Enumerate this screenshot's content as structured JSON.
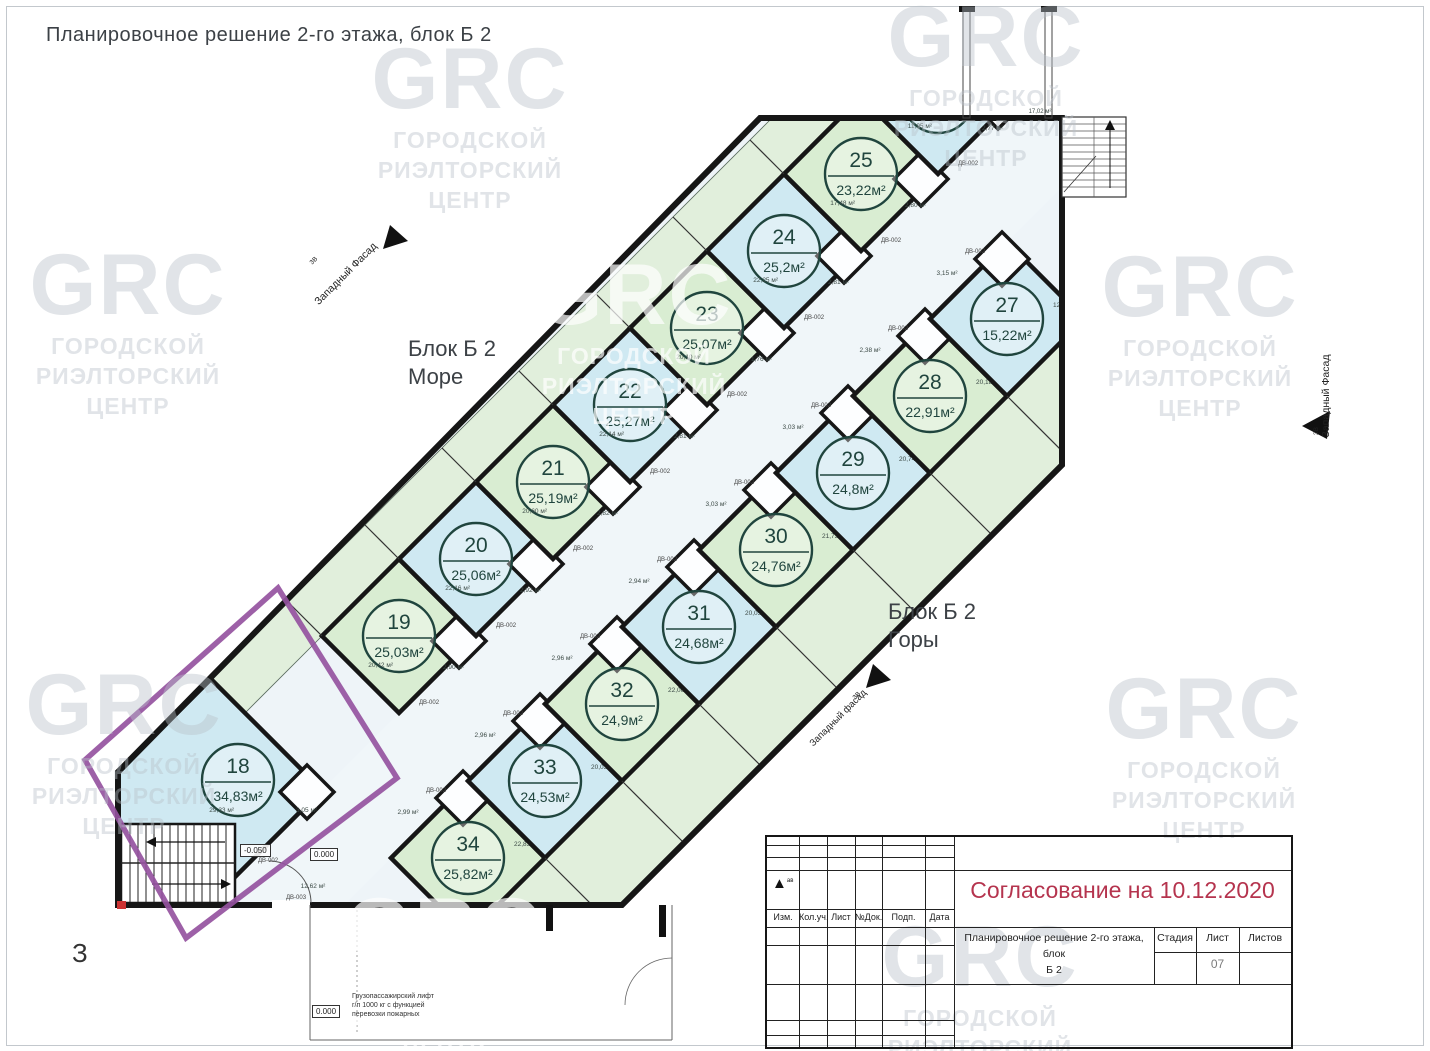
{
  "title": "Планировочное решение 2-го этажа, блок Б 2",
  "watermark": {
    "logo": "GRC",
    "lines": [
      "ГОРОДСКОЙ",
      "РИЭЛТОРСКИЙ",
      "ЦЕНТР"
    ]
  },
  "colors": {
    "wall": "#161616",
    "blue": "#cfe9f2",
    "green": "#d9edd2",
    "corridor": "#f0f6f9",
    "balcony": "#e1efdc",
    "base": "#eef4f8",
    "circle": "#20453e",
    "purple": "#9552a0",
    "red": "#b5344e"
  },
  "plan": {
    "block_labels": {
      "sea": {
        "line1": "Блок Б 2",
        "line2": "Море"
      },
      "mountains": {
        "line1": "Блок Б 2",
        "line2": "Горы"
      }
    },
    "facade": {
      "label": "Западный Фасад",
      "label_alt": "Западный фасад",
      "axis": "3В"
    },
    "axis_letter": "З",
    "elevations": {
      "stairs": "-0.050",
      "entry": "0.000",
      "ground": "0.000"
    },
    "lift_note": [
      "Грузопассажирский лифт",
      "г/п 1000 кг с функцией",
      "перевозки пожарных"
    ],
    "door_label_main": "ДВ-002",
    "door_label_exit": "ДВ-003",
    "lobby_dim": "12,62 м²",
    "landing_dim": "17,02 м²",
    "units_sea": [
      {
        "num": "18",
        "area": "34,83м²",
        "color": "blue",
        "room_dim": "29,33 м²",
        "bath_dim": "3,05 м²"
      },
      {
        "num": "19",
        "area": "25,03м²",
        "color": "green",
        "room_dim": "20,42 м²",
        "bath_dim": "2,90 м²"
      },
      {
        "num": "20",
        "area": "25,06м²",
        "color": "blue",
        "room_dim": "22,16 м²",
        "bath_dim": "2,92 м²"
      },
      {
        "num": "21",
        "area": "25,19м²",
        "color": "green",
        "room_dim": "20,60 м²",
        "bath_dim": "2,82 м²"
      },
      {
        "num": "22",
        "area": "25,27м²",
        "color": "blue",
        "room_dim": "22,14 м²",
        "bath_dim": "2,81 м²"
      },
      {
        "num": "23",
        "area": "25,07м²",
        "color": "green",
        "room_dim": "20,10 м²",
        "bath_dim": "1,76 м²"
      },
      {
        "num": "24",
        "area": "25,2м²",
        "color": "blue",
        "room_dim": "22,25 м²",
        "bath_dim": "2,81 м²"
      },
      {
        "num": "25",
        "area": "23,22м²",
        "color": "green",
        "room_dim": "17,48 м²",
        "bath_dim": "2,80 м²"
      },
      {
        "num": "26",
        "area": "14,72м²",
        "color": "blue",
        "room_dim": "11,95 м²",
        "bath_dim": "2,77 м²"
      }
    ],
    "units_mountains": [
      {
        "num": "34",
        "area": "25,82м²",
        "color": "green",
        "room_dim": "22,83 м²",
        "bath_dim": "2,99 м²"
      },
      {
        "num": "33",
        "area": "24,53м²",
        "color": "blue",
        "room_dim": "20,03 м²",
        "bath_dim": "2,96 м²"
      },
      {
        "num": "32",
        "area": "24,9м²",
        "color": "green",
        "room_dim": "22,06 м²",
        "bath_dim": "2,96 м²"
      },
      {
        "num": "31",
        "area": "24,68м²",
        "color": "blue",
        "room_dim": "20,05 м²",
        "bath_dim": "2,94 м²"
      },
      {
        "num": "30",
        "area": "24,76м²",
        "color": "green",
        "room_dim": "21,73 м²",
        "bath_dim": "3,03 м²"
      },
      {
        "num": "29",
        "area": "24,8м²",
        "color": "blue",
        "room_dim": "20,74 м²",
        "bath_dim": "3,03 м²"
      },
      {
        "num": "28",
        "area": "22,91м²",
        "color": "green",
        "room_dim": "20,18 м²",
        "bath_dim": "2,38 м²"
      },
      {
        "num": "27",
        "area": "15,22м²",
        "color": "blue",
        "room_dim": "12,30 м²",
        "bath_dim": "3,15 м²"
      }
    ]
  },
  "titleblock": {
    "approval": "Согласование на 10.12.2020",
    "columns": [
      "Изм.",
      "Кол.уч.",
      "Лист",
      "№Док.",
      "Подп.",
      "Дата"
    ],
    "doc_title_line1": "Планировочное решение 2-го этажа, блок",
    "doc_title_line2": "Б 2",
    "stage_label": "Стадия",
    "sheet_label": "Лист",
    "sheets_label": "Листов",
    "sheet_number": "07",
    "revision_mark": "ав"
  }
}
